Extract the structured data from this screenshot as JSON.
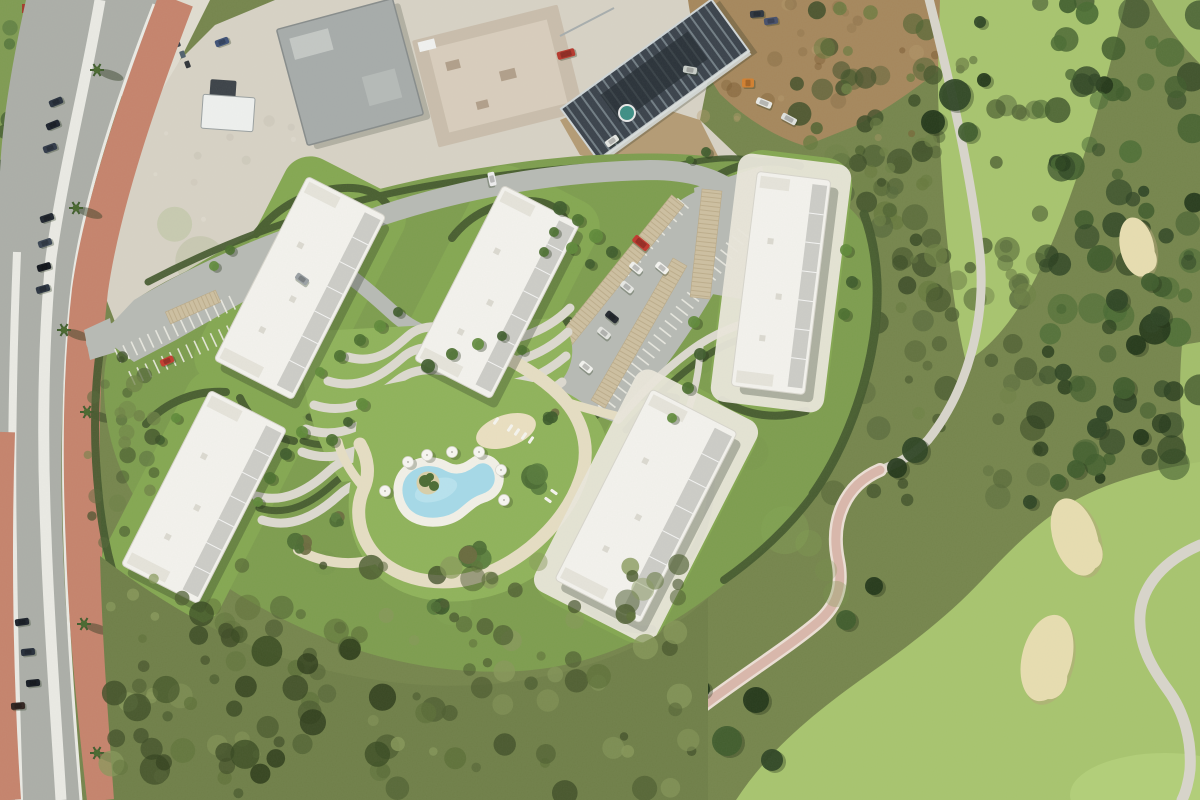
{
  "meta": {
    "description": "aerial-photo-of-residential-masterplan-render-next-to-golf-course",
    "width": 1200,
    "height": 800
  },
  "palette": {
    "scrubBase": "#75854c",
    "grassLeft": "#7f9b52",
    "fairway": "#a7c46e",
    "fairwayLight": "#b2cf78",
    "bunkerSand": "#e7ddb0",
    "bunkerShadow": "#b3a678",
    "cartPath": "#d8d5cb",
    "cartPathPink": "#d9b7ab",
    "cartPathPinkEdge": "#ecdfd5",
    "asphalt": "#abaea8",
    "lineWhite": "#eaeae4",
    "brick": "#c5836c",
    "gravel": "#d7d2c5",
    "gravelLight": "#e0dcd0",
    "dirtBrown": "#a5875c",
    "warehouseGray": "#a6abaa",
    "warehouseLight": "#c3c7c4",
    "concrete": "#c9bdac",
    "concreteLight": "#d8cdbc",
    "darkRoof": "#3a424b",
    "joist": "#717d84",
    "scaffold": "#d9dedd",
    "tealPool": "#3d8e85",
    "siteLawn": "#7d9d4e",
    "lawnBright": "#8fb35a",
    "lawnHalo": "#84a751",
    "hedge": "#44592e",
    "roadLight": "#b7bab4",
    "pathLight": "#dcd9cf",
    "sandy": "#e5ddc3",
    "playgroundSand": "#eadfc0",
    "poolBlue": "#a5d9e8",
    "poolBlueLight": "#c6e9f2",
    "deckWhite": "#f2f0e7",
    "buildingWhite": "#f3f2ed",
    "buildingEdge": "#d7d5cc",
    "terrace": "#c8c8c2",
    "roofJog": "#e5e3da",
    "carport": "#cdbfa0",
    "carportSlat": "#b9a987",
    "islandSand": "#d8cfa9",
    "shadow": "rgba(30,40,25,0.28)",
    "stallTick": "#ecebe3"
  },
  "scene": {
    "buildings": [
      {
        "name": "residential-block-1",
        "cx": 300,
        "cy": 288,
        "w": 88,
        "h": 206,
        "rot": 27,
        "apron": false
      },
      {
        "name": "residential-block-2",
        "cx": 497,
        "cy": 292,
        "w": 86,
        "h": 196,
        "rot": 27,
        "apron": false
      },
      {
        "name": "residential-block-3",
        "cx": 204,
        "cy": 497,
        "w": 86,
        "h": 196,
        "rot": 27,
        "apron": false
      },
      {
        "name": "residential-block-4",
        "cx": 646,
        "cy": 506,
        "w": 96,
        "h": 214,
        "rot": 27,
        "apron": true
      },
      {
        "name": "residential-block-5",
        "cx": 781,
        "cy": 283,
        "w": 74,
        "h": 216,
        "rot": 7,
        "apron": true
      }
    ],
    "mottle": [
      {
        "layer": "tl-trees",
        "x": 0,
        "y": 0,
        "w": 92,
        "h": 175,
        "n": 26,
        "rmin": 4,
        "rmax": 11,
        "colors": [
          "#3f5930",
          "#2e4424",
          "#55763c"
        ],
        "omin": 0.5,
        "omax": 0.9
      },
      {
        "layer": "gravel-specks",
        "x": 130,
        "y": 80,
        "w": 570,
        "h": 170,
        "n": 30,
        "rmin": 2,
        "rmax": 6,
        "colors": [
          "#c6c1b2",
          "#e3dfd4",
          "#b7b1a1"
        ],
        "omin": 0.3,
        "omax": 0.5
      },
      {
        "layer": "dirt-specks",
        "x": 700,
        "y": 4,
        "w": 250,
        "h": 136,
        "n": 26,
        "rmin": 3,
        "rmax": 8,
        "colors": [
          "#8a6f47",
          "#b69a6d",
          "#77572f"
        ],
        "omin": 0.3,
        "omax": 0.55
      },
      {
        "layer": "golf-scrub",
        "x": 795,
        "y": 0,
        "w": 140,
        "h": 310,
        "n": 48,
        "rmin": 4,
        "rmax": 12,
        "colors": [
          "#4e6231",
          "#3a4b26",
          "#66793d"
        ],
        "omin": 0.45,
        "omax": 0.85
      },
      {
        "layer": "golf-scrub",
        "x": 820,
        "y": 60,
        "w": 220,
        "h": 440,
        "n": 95,
        "rmin": 4,
        "rmax": 13,
        "colors": [
          "#55673a",
          "#3d4e28",
          "#6e8146",
          "#47582e"
        ],
        "omin": 0.4,
        "omax": 0.8
      },
      {
        "layer": "golf-scrub",
        "x": 1040,
        "y": 0,
        "w": 160,
        "h": 480,
        "n": 95,
        "rmin": 5,
        "rmax": 16,
        "colors": [
          "#2e4424",
          "#223619",
          "#3f5c2c",
          "#4a6b33"
        ],
        "omin": 0.5,
        "omax": 0.95
      },
      {
        "layer": "site-texture",
        "x": 150,
        "y": 210,
        "w": 690,
        "h": 410,
        "n": 36,
        "rmin": 10,
        "rmax": 26,
        "colors": [
          "#74944a",
          "#86a957"
        ],
        "omin": 0.15,
        "omax": 0.3
      },
      {
        "layer": "bottom-scrub",
        "x": 108,
        "y": 560,
        "w": 595,
        "h": 235,
        "n": 130,
        "rmin": 4,
        "rmax": 13,
        "colors": [
          "#4e5e31",
          "#5d7038",
          "#87985a",
          "#3f4d27"
        ],
        "omin": 0.45,
        "omax": 0.85
      },
      {
        "layer": "bottom-scrub",
        "x": 130,
        "y": 600,
        "w": 290,
        "h": 180,
        "n": 18,
        "rmin": 8,
        "rmax": 16,
        "colors": [
          "#35471f",
          "#2b3a19"
        ],
        "omin": 0.55,
        "omax": 0.85
      },
      {
        "layer": "bottom-scrub",
        "x": 86,
        "y": 350,
        "w": 70,
        "h": 215,
        "n": 26,
        "rmin": 3,
        "rmax": 9,
        "colors": [
          "#55673a",
          "#3d4e28",
          "#6e8146"
        ],
        "omin": 0.4,
        "omax": 0.8
      }
    ],
    "golfTrees": [
      [
        955,
        95,
        16
      ],
      [
        933,
        122,
        12
      ],
      [
        968,
        132,
        10
      ],
      [
        915,
        450,
        13
      ],
      [
        897,
        468,
        10
      ],
      [
        1100,
        258,
        13
      ],
      [
        1117,
        300,
        11
      ],
      [
        1136,
        345,
        10
      ],
      [
        1124,
        388,
        11
      ],
      [
        1097,
        428,
        10
      ],
      [
        1141,
        437,
        8
      ],
      [
        1076,
        469,
        9
      ],
      [
        980,
        22,
        6
      ],
      [
        984,
        80,
        7
      ],
      [
        1150,
        282,
        9
      ],
      [
        1160,
        316,
        10
      ],
      [
        756,
        700,
        13
      ],
      [
        727,
        741,
        15
      ],
      [
        772,
        760,
        11
      ],
      [
        701,
        689,
        9
      ],
      [
        1058,
        482,
        8
      ],
      [
        1030,
        502,
        7
      ],
      [
        874,
        586,
        9
      ],
      [
        846,
        620,
        10
      ]
    ],
    "golfTreeColors": [
      "#2e4424",
      "#223619",
      "#3f5c2c"
    ],
    "siteTrees": [
      [
        360,
        340,
        6
      ],
      [
        380,
        326,
        6
      ],
      [
        398,
        312,
        5
      ],
      [
        340,
        356,
        6
      ],
      [
        320,
        372,
        5
      ],
      [
        428,
        366,
        7
      ],
      [
        452,
        354,
        6
      ],
      [
        478,
        344,
        6
      ],
      [
        502,
        336,
        5
      ],
      [
        522,
        350,
        5
      ],
      [
        362,
        404,
        6
      ],
      [
        348,
        422,
        5
      ],
      [
        332,
        440,
        6
      ],
      [
        302,
        432,
        6
      ],
      [
        286,
        454,
        6
      ],
      [
        270,
        478,
        6
      ],
      [
        258,
        502,
        5
      ],
      [
        560,
        208,
        7
      ],
      [
        578,
        220,
        6
      ],
      [
        596,
        236,
        7
      ],
      [
        612,
        252,
        6
      ],
      [
        554,
        232,
        5
      ],
      [
        572,
        248,
        6
      ],
      [
        590,
        264,
        5
      ],
      [
        544,
        252,
        5
      ],
      [
        694,
        322,
        6
      ],
      [
        700,
        354,
        6
      ],
      [
        688,
        388,
        6
      ],
      [
        672,
        418,
        5
      ],
      [
        706,
        152,
        5
      ],
      [
        690,
        160,
        4
      ],
      [
        846,
        250,
        6
      ],
      [
        852,
        282,
        6
      ],
      [
        844,
        314,
        6
      ],
      [
        176,
        418,
        5
      ],
      [
        160,
        440,
        5
      ],
      [
        230,
        250,
        5
      ],
      [
        214,
        266,
        5
      ]
    ],
    "siteTreeColors": [
      "#4c7030",
      "#5f8a3a",
      "#3f5c2c"
    ],
    "bunkers": [
      {
        "cx": 1137,
        "cy": 247,
        "rx": 17,
        "ry": 30,
        "rot": -12
      },
      {
        "cx": 1075,
        "cy": 537,
        "rx": 22,
        "ry": 40,
        "rot": -18
      },
      {
        "cx": 1047,
        "cy": 658,
        "rx": 25,
        "ry": 44,
        "rot": 14
      }
    ],
    "carports": [
      {
        "x1": 548,
        "y1": 362,
        "x2": 678,
        "y2": 200,
        "w": 16
      },
      {
        "x1": 598,
        "y1": 404,
        "x2": 680,
        "y2": 262,
        "w": 16
      },
      {
        "x1": 712,
        "y1": 190,
        "x2": 700,
        "y2": 298,
        "w": 20
      },
      {
        "x1": 168,
        "y1": 318,
        "x2": 218,
        "y2": 296,
        "w": 13
      }
    ],
    "stallRows": [
      {
        "x1": 118,
        "y1": 356,
        "x2": 238,
        "y2": 300
      },
      {
        "x1": 132,
        "y1": 378,
        "x2": 252,
        "y2": 322
      },
      {
        "x1": 552,
        "y1": 352,
        "x2": 688,
        "y2": 198
      },
      {
        "x1": 604,
        "y1": 410,
        "x2": 744,
        "y2": 232
      }
    ],
    "palms": [
      [
        97,
        70
      ],
      [
        76,
        208
      ],
      [
        87,
        412
      ],
      [
        84,
        624
      ],
      [
        97,
        753
      ],
      [
        64,
        330
      ]
    ],
    "umbrellas": [
      [
        408,
        462
      ],
      [
        427,
        455
      ],
      [
        452,
        452
      ],
      [
        479,
        452
      ],
      [
        501,
        470
      ],
      [
        504,
        500
      ],
      [
        385,
        491
      ]
    ],
    "loungers": [
      [
        510,
        428,
        35
      ],
      [
        517,
        432,
        35
      ],
      [
        524,
        436,
        35
      ],
      [
        531,
        440,
        35
      ],
      [
        496,
        421,
        35
      ],
      [
        548,
        500,
        -55
      ],
      [
        554,
        492,
        -55
      ]
    ],
    "bushes": [
      [
        537,
        479,
        16
      ],
      [
        475,
        552,
        14
      ],
      [
        552,
        416,
        9
      ],
      [
        300,
        546,
        11
      ],
      [
        438,
        604,
        10
      ],
      [
        338,
        519,
        8
      ]
    ],
    "bushColors": [
      "#4b6b33",
      "#3c5a2a",
      "#587b3c",
      "#6b6a3f"
    ],
    "bins": [
      [
        169,
        30
      ],
      [
        174,
        41
      ],
      [
        179,
        52
      ],
      [
        184,
        62
      ]
    ],
    "binColors": [
      "#2ba59a",
      "#3a4048",
      "#50616d",
      "#2f3338"
    ],
    "cars": {
      "road": [
        [
          56,
          102,
          -22,
          "#2a3340"
        ],
        [
          53,
          125,
          -22,
          "#1d232e"
        ],
        [
          50,
          148,
          -20,
          "#313a49"
        ],
        [
          47,
          218,
          -18,
          "#20262f"
        ],
        [
          45,
          243,
          -18,
          "#394452"
        ],
        [
          44,
          267,
          -16,
          "#12161d"
        ],
        [
          43,
          289,
          -16,
          "#2c3542"
        ],
        [
          22,
          622,
          -8,
          "#1c222b"
        ],
        [
          28,
          652,
          -6,
          "#262e3a"
        ],
        [
          33,
          683,
          -6,
          "#161b23"
        ],
        [
          18,
          706,
          -4,
          "#30231f"
        ],
        [
          222,
          42,
          -20,
          "#3f5277"
        ],
        [
          112,
          394,
          -8,
          "#e8e8e4"
        ]
      ],
      "site": [
        [
          167,
          361,
          -24,
          "#c23b2e"
        ],
        [
          302,
          279,
          35,
          "#9aa0a4"
        ],
        [
          492,
          179,
          78,
          "#ededee"
        ],
        [
          641,
          243,
          39,
          "#c0392e",
          18,
          8
        ],
        [
          636,
          268,
          39,
          "#f0f0ec"
        ],
        [
          627,
          287,
          39,
          "#e6e7e3"
        ],
        [
          612,
          317,
          39,
          "#23282f"
        ],
        [
          604,
          333,
          39,
          "#e2e3df"
        ],
        [
          586,
          367,
          39,
          "#f2f2ee"
        ],
        [
          662,
          268,
          39,
          "#f4f4f0"
        ]
      ],
      "top": [
        [
          757,
          14,
          -5,
          "#2e3640"
        ],
        [
          771,
          21,
          -8,
          "#47506b"
        ],
        [
          566,
          54,
          -15,
          "#b5372c",
          18,
          8
        ],
        [
          748,
          83,
          0,
          "#d27f2f",
          12,
          9
        ],
        [
          764,
          103,
          22,
          "#e8e9e5",
          16,
          7
        ],
        [
          789,
          119,
          28,
          "#dfe1dd",
          16,
          7
        ],
        [
          612,
          141,
          -35,
          "#e4e6e2"
        ],
        [
          690,
          70,
          10,
          "#c9cec9"
        ]
      ]
    },
    "islandBushes": [
      [
        425,
        481,
        6
      ],
      [
        434,
        486,
        5
      ],
      [
        430,
        477,
        4
      ]
    ]
  }
}
